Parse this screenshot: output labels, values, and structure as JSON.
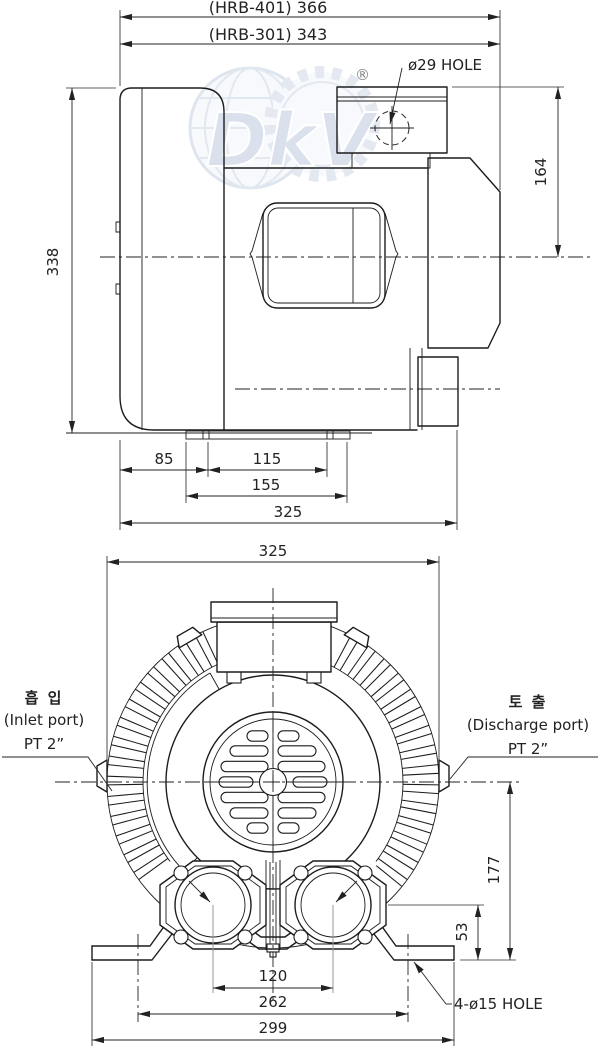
{
  "watermark": {
    "logo_text": "DkV",
    "registered_mark": "®"
  },
  "side_view": {
    "dim_overall_hrb401": "(HRB-401) 366",
    "dim_overall_hrb301": "(HRB-301) 343",
    "hole_label": "ø29 HOLE",
    "dim_total_height": "338",
    "dim_terminal_height": "164",
    "dim_base_offset": "85",
    "dim_base_inner": "115",
    "dim_base_flange": "155",
    "dim_depth": "325"
  },
  "front_view": {
    "dim_width": "325",
    "dim_center_height": "177",
    "dim_port_height": "53",
    "dim_port_spacing": "120",
    "dim_foot_hole_spacing": "262",
    "dim_base_width": "299",
    "foot_hole_label": "4-ø15 HOLE",
    "inlet": {
      "korean": "흡 입",
      "english": "(Inlet port)",
      "size": "PT 2”"
    },
    "discharge": {
      "korean": "토 출",
      "english": "(Discharge port)",
      "size": "PT 2”"
    }
  },
  "colors": {
    "line": "#1c1c1c",
    "dimension": "#222222",
    "extension_gray": "#979797",
    "watermark_blue": "#bccadf"
  }
}
